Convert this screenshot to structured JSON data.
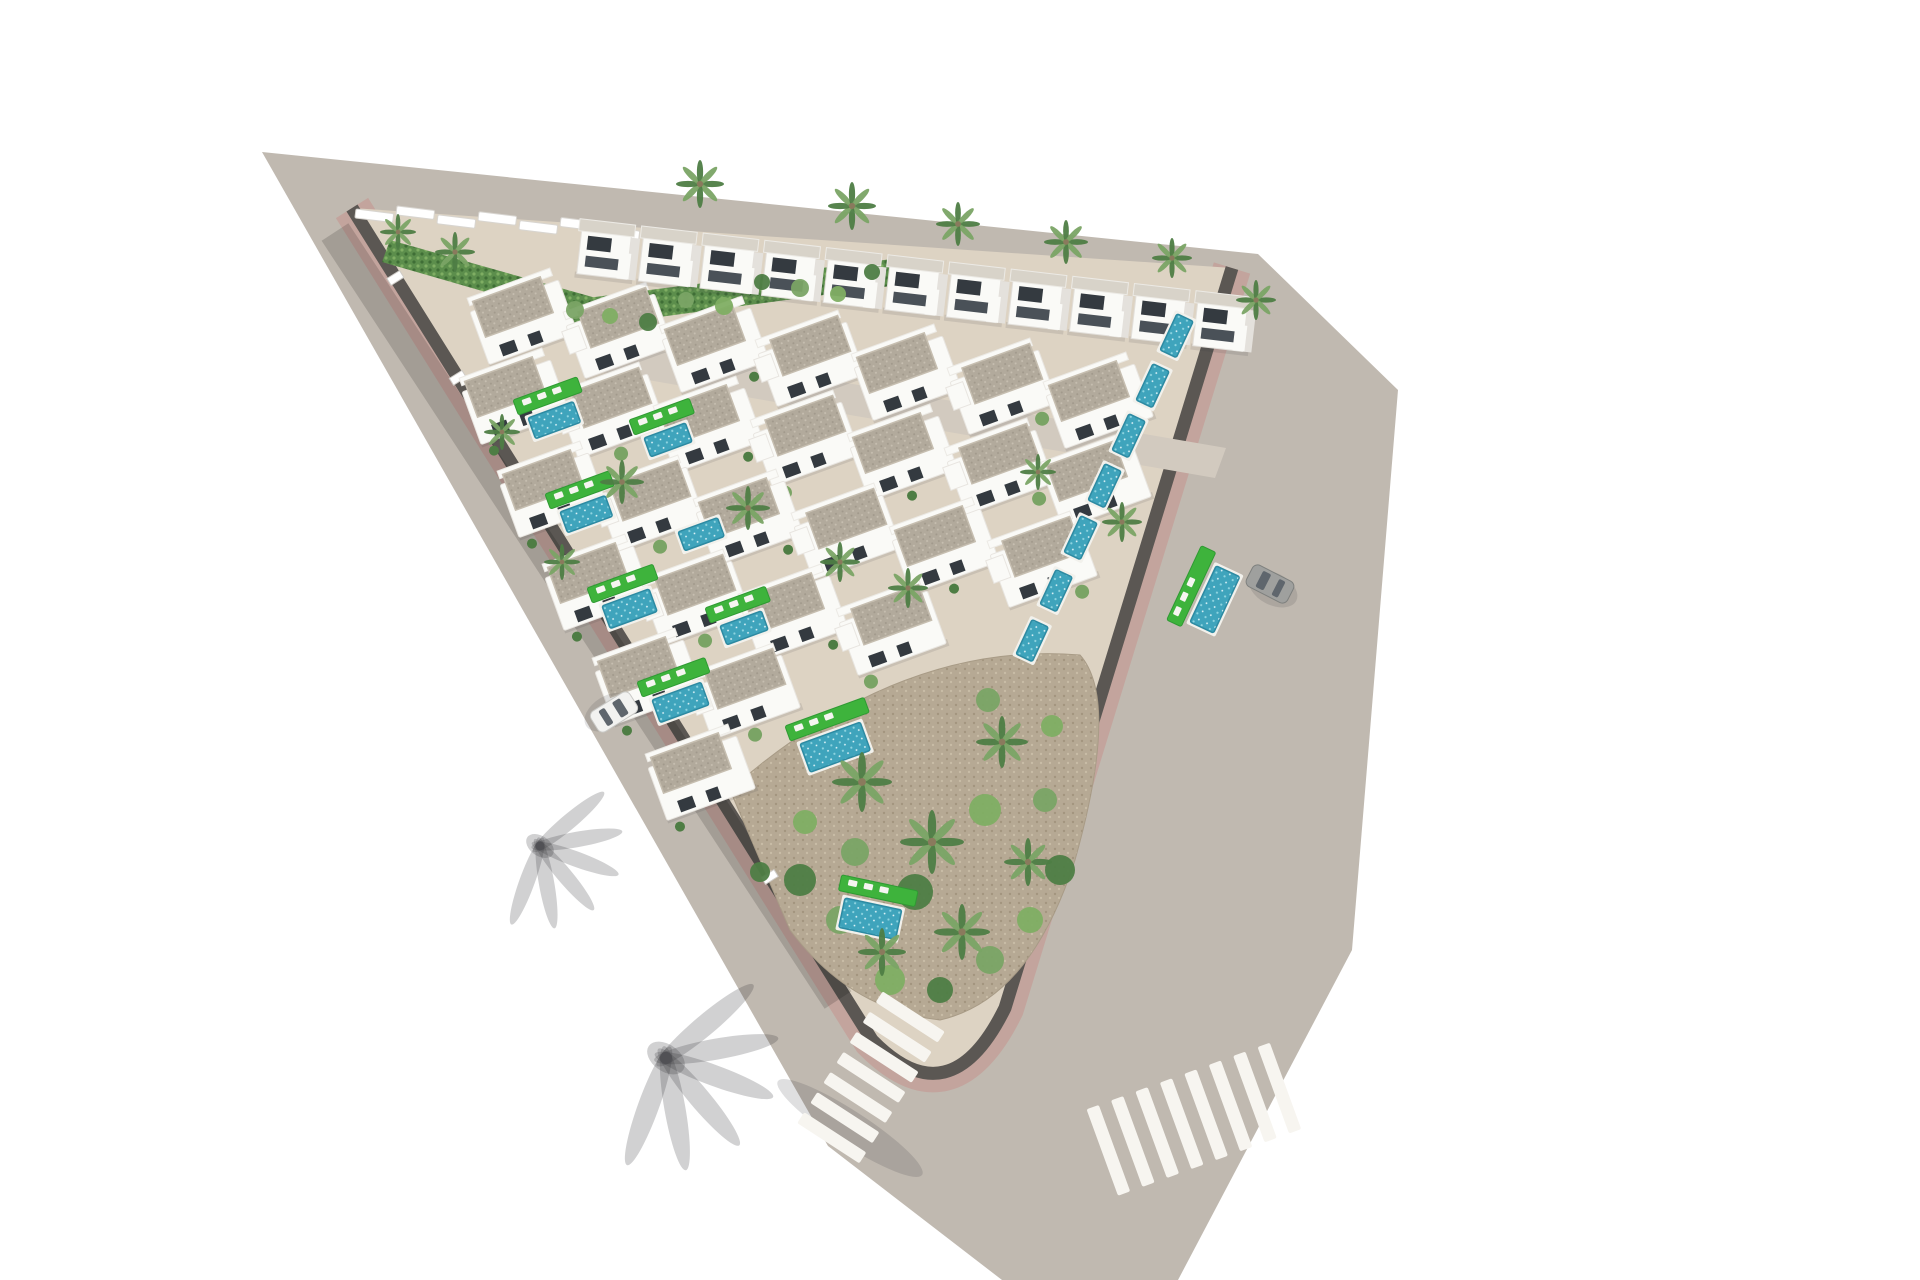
{
  "canvas": {
    "width": 1920,
    "height": 1280,
    "background": "#ffffff"
  },
  "palette": {
    "road": "#c0b9b0",
    "road_inner": "#d2cabf",
    "sidewalk": "#c3a49d",
    "curb_wall": "#5b5753",
    "plot_ground": "#ddd3c3",
    "villa_white": "#fafaf7",
    "villa_shade": "#e4e1dc",
    "roof_light": "#d8d3c9",
    "roof_gravel": "#b2aa9c",
    "roof_gravel_dark": "#a1998b",
    "roof_gravel_light": "#c7bfb1",
    "window_dark": "#343a40",
    "pool_water": "#3fa4bc",
    "pool_light": "#8ed4e0",
    "lawn_green": "#3eb33c",
    "lawn_dark": "#2f9a33",
    "hedge_green": "#5c8e4c",
    "hedge_light": "#7fae63",
    "hedge_dark": "#3f6e36",
    "palm_green": "#7aa465",
    "bush_dark": "#4e7d44",
    "dirt_garden": "#b6a994",
    "dirt_dark": "#a3957f",
    "dirt_light": "#c8bca6",
    "crosswalk": "#f7f5f0",
    "car_white": "#f2f2f0",
    "car_grey": "#9fa09e",
    "car_glass": "#5f666d"
  },
  "scene": {
    "top_villa_row": {
      "count": 11,
      "start": [
        582,
        228
      ],
      "end": [
        1198,
        300
      ],
      "rotation": 6.6
    },
    "bungalow_rows": [
      {
        "start": [
          470,
          312
        ],
        "units": 7,
        "step": [
          96,
          14
        ]
      },
      {
        "start": [
          462,
          392
        ],
        "units": 7,
        "step": [
          97,
          14
        ]
      },
      {
        "start": [
          500,
          485
        ],
        "units": 6,
        "step": [
          98,
          14
        ]
      },
      {
        "start": [
          545,
          578
        ],
        "units": 4,
        "step": [
          98,
          15
        ]
      },
      {
        "start": [
          595,
          672
        ],
        "units": 2,
        "step": [
          98,
          15
        ]
      },
      {
        "start": [
          648,
          768
        ],
        "units": 1,
        "step": [
          98,
          15
        ]
      }
    ],
    "unit_rotation": -20,
    "pools": [
      {
        "x": 528,
        "y": 418,
        "rot": -20,
        "w": 48,
        "h": 22,
        "lawn": true
      },
      {
        "x": 644,
        "y": 438,
        "rot": -20,
        "w": 44,
        "h": 20,
        "lawn": true
      },
      {
        "x": 560,
        "y": 512,
        "rot": -20,
        "w": 48,
        "h": 22,
        "lawn": true
      },
      {
        "x": 678,
        "y": 532,
        "rot": -20,
        "w": 42,
        "h": 20,
        "lawn": false
      },
      {
        "x": 602,
        "y": 606,
        "rot": -20,
        "w": 50,
        "h": 24,
        "lawn": true
      },
      {
        "x": 720,
        "y": 626,
        "rot": -20,
        "w": 44,
        "h": 20,
        "lawn": true
      },
      {
        "x": 652,
        "y": 700,
        "rot": -20,
        "w": 52,
        "h": 24,
        "lawn": true
      },
      {
        "x": 800,
        "y": 744,
        "rot": -20,
        "w": 64,
        "h": 30,
        "lawn": true
      },
      {
        "x": 845,
        "y": 898,
        "rot": 12,
        "w": 58,
        "h": 30,
        "lawn": true
      },
      {
        "x": 1160,
        "y": 350,
        "rot": -65,
        "w": 40,
        "h": 18,
        "lawn": false
      },
      {
        "x": 1136,
        "y": 400,
        "rot": -65,
        "w": 40,
        "h": 18,
        "lawn": false
      },
      {
        "x": 1112,
        "y": 450,
        "rot": -65,
        "w": 40,
        "h": 18,
        "lawn": false
      },
      {
        "x": 1088,
        "y": 500,
        "rot": -65,
        "w": 40,
        "h": 18,
        "lawn": false
      },
      {
        "x": 1064,
        "y": 552,
        "rot": -65,
        "w": 40,
        "h": 18,
        "lawn": false
      },
      {
        "x": 1190,
        "y": 622,
        "rot": -65,
        "w": 62,
        "h": 26,
        "lawn": true
      },
      {
        "x": 1040,
        "y": 604,
        "rot": -65,
        "w": 38,
        "h": 18,
        "lawn": false
      },
      {
        "x": 1016,
        "y": 654,
        "rot": -65,
        "w": 38,
        "h": 18,
        "lawn": false
      }
    ],
    "palms": [
      [
        455,
        252,
        1.0
      ],
      [
        700,
        184,
        1.2
      ],
      [
        852,
        206,
        1.2
      ],
      [
        958,
        224,
        1.1
      ],
      [
        1066,
        242,
        1.1
      ],
      [
        1172,
        258,
        1.0
      ],
      [
        1256,
        300,
        1.0
      ],
      [
        398,
        232,
        0.9
      ],
      [
        622,
        482,
        1.1
      ],
      [
        748,
        508,
        1.1
      ],
      [
        840,
        562,
        1.0
      ],
      [
        908,
        588,
        1.0
      ],
      [
        562,
        562,
        0.9
      ],
      [
        502,
        432,
        0.9
      ],
      [
        1122,
        522,
        1.0
      ],
      [
        1038,
        472,
        0.9
      ],
      [
        862,
        782,
        1.5
      ],
      [
        932,
        842,
        1.6
      ],
      [
        1002,
        742,
        1.3
      ],
      [
        962,
        932,
        1.4
      ],
      [
        882,
        952,
        1.2
      ],
      [
        1028,
        862,
        1.2
      ]
    ],
    "garden_bushes": [
      [
        800,
        880,
        16,
        0
      ],
      [
        840,
        920,
        14,
        1
      ],
      [
        890,
        980,
        15,
        2
      ],
      [
        940,
        990,
        13,
        0
      ],
      [
        990,
        960,
        14,
        1
      ],
      [
        1030,
        920,
        13,
        2
      ],
      [
        1060,
        870,
        15,
        0
      ],
      [
        1045,
        800,
        12,
        1
      ],
      [
        985,
        810,
        16,
        2
      ],
      [
        915,
        892,
        18,
        0
      ],
      [
        855,
        852,
        14,
        1
      ],
      [
        805,
        822,
        12,
        2
      ],
      [
        760,
        872,
        10,
        0
      ],
      [
        988,
        700,
        12,
        1
      ],
      [
        1052,
        726,
        11,
        2
      ]
    ],
    "slope_bushes": [
      [
        575,
        310,
        9,
        1
      ],
      [
        610,
        316,
        8,
        2
      ],
      [
        648,
        322,
        9,
        0
      ],
      [
        686,
        300,
        8,
        1
      ],
      [
        724,
        306,
        9,
        2
      ],
      [
        762,
        282,
        8,
        0
      ],
      [
        800,
        288,
        9,
        1
      ],
      [
        838,
        294,
        8,
        2
      ],
      [
        872,
        272,
        8,
        0
      ]
    ],
    "left_edge": {
      "a": [
        352,
        208
      ],
      "b": [
        872,
        1040
      ]
    },
    "fence_posts_t": [
      0.08,
      0.2,
      0.32,
      0.44,
      0.56,
      0.68,
      0.8
    ],
    "wall_steps": {
      "count": 7,
      "start": [
        356,
        206
      ],
      "step": [
        41,
        2.9
      ]
    },
    "crosswalks": [
      {
        "x": 868,
        "y": 1082,
        "rot": 33,
        "bars": 7,
        "bar_w": 74,
        "bar_h": 13,
        "gap": 24,
        "orient": "h"
      },
      {
        "x": 1200,
        "y": 1117,
        "rot": -20,
        "bars": 8,
        "bar_w": 13,
        "bar_h": 92,
        "gap": 26,
        "orient": "v"
      }
    ],
    "cars": [
      {
        "x": 614,
        "y": 712,
        "rot": 58,
        "type": "white"
      },
      {
        "x": 1270,
        "y": 584,
        "rot": -63,
        "type": "grey"
      }
    ],
    "road_palm_shadows": [
      [
        540,
        846,
        35,
        1.1
      ],
      [
        666,
        1058,
        35,
        1.5
      ]
    ]
  }
}
